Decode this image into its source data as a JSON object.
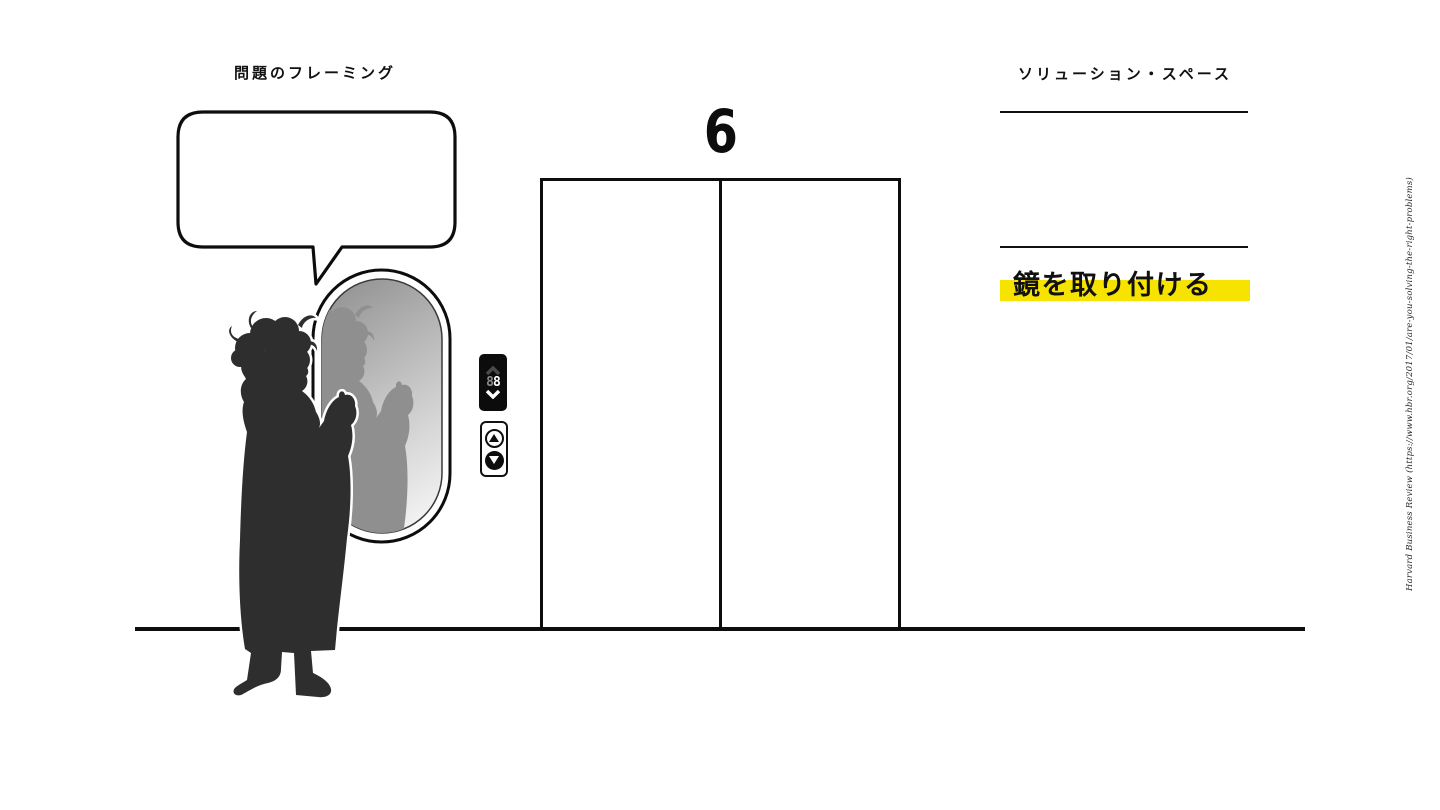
{
  "slide": {
    "problem_framing_title": "問題のフレーミング",
    "solution_space_title": "ソリューション・スペース",
    "solution_answer": "鏡を取り付ける",
    "floor_number": "6",
    "citation": "Harvard Business Review (https://www.hbr.org/2017/01/are-you-solving-the-right-problems)"
  },
  "indicator": {
    "dim_digit": "8",
    "lit_digit": "8"
  },
  "colors": {
    "highlight_yellow": "#F6E300",
    "silhouette": "#2e2e2e",
    "reflection": "#8f8f8f",
    "line_black": "#0d0d0d"
  },
  "icons": {
    "up_chevron": "chevron-up",
    "down_chevron": "chevron-down",
    "up_arrow": "triangle-up",
    "down_arrow": "triangle-down"
  }
}
